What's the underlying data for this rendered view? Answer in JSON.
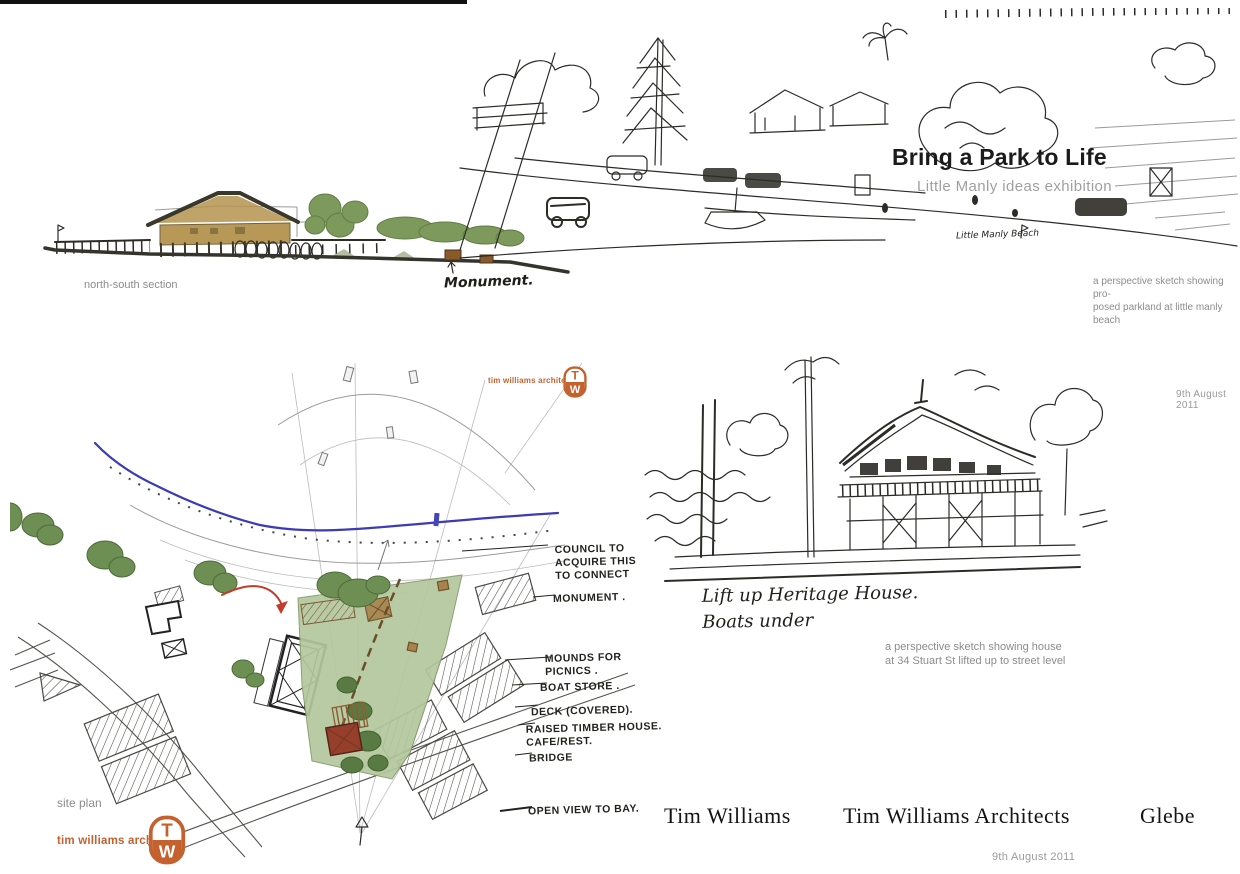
{
  "colors": {
    "accent_orange": "#c4612f",
    "park_green": "#b4c79d",
    "tree_green": "#6d8f53",
    "building_red": "#96402c",
    "water_blue": "#3b3bb5",
    "ink": "#2c2b26",
    "caption_gray": "#8c8c8c"
  },
  "section_panel": {
    "caption": "north-south section",
    "annotation": "Monument."
  },
  "perspective_panel": {
    "title": "Bring a Park to Life",
    "subtitle": "Little Manly ideas exhibition",
    "annotation": "Little Manly Beach",
    "caption": "a perspective sketch showing pro-\nposed parkland at little manly beach",
    "date": "9th August  2011"
  },
  "site_plan": {
    "caption": "site plan",
    "firm": "tim williams architects",
    "logo": {
      "top": "T",
      "bottom": "W"
    },
    "labels": [
      {
        "text": "COUNCIL TO\nACQUIRE THIS\nTO CONNECT"
      },
      {
        "text": "MONUMENT ."
      },
      {
        "text": "MOUNDS FOR\nPICNICS ."
      },
      {
        "text": "BOAT STORE ."
      },
      {
        "text": "DECK (COVERED)."
      },
      {
        "text": "RAISED TIMBER HOUSE.\nCAFE/REST."
      },
      {
        "text": "BRIDGE"
      },
      {
        "text": "OPEN VIEW TO BAY."
      }
    ]
  },
  "house_panel": {
    "annotation": "Lift up Heritage House.\nBoats under",
    "caption": "a perspective sketch showing house\nat 34 Stuart St lifted up to street level"
  },
  "footer": {
    "name": "Tim Williams",
    "firm": "Tim Williams Architects",
    "location": "Glebe",
    "date": "9th August  2011"
  }
}
